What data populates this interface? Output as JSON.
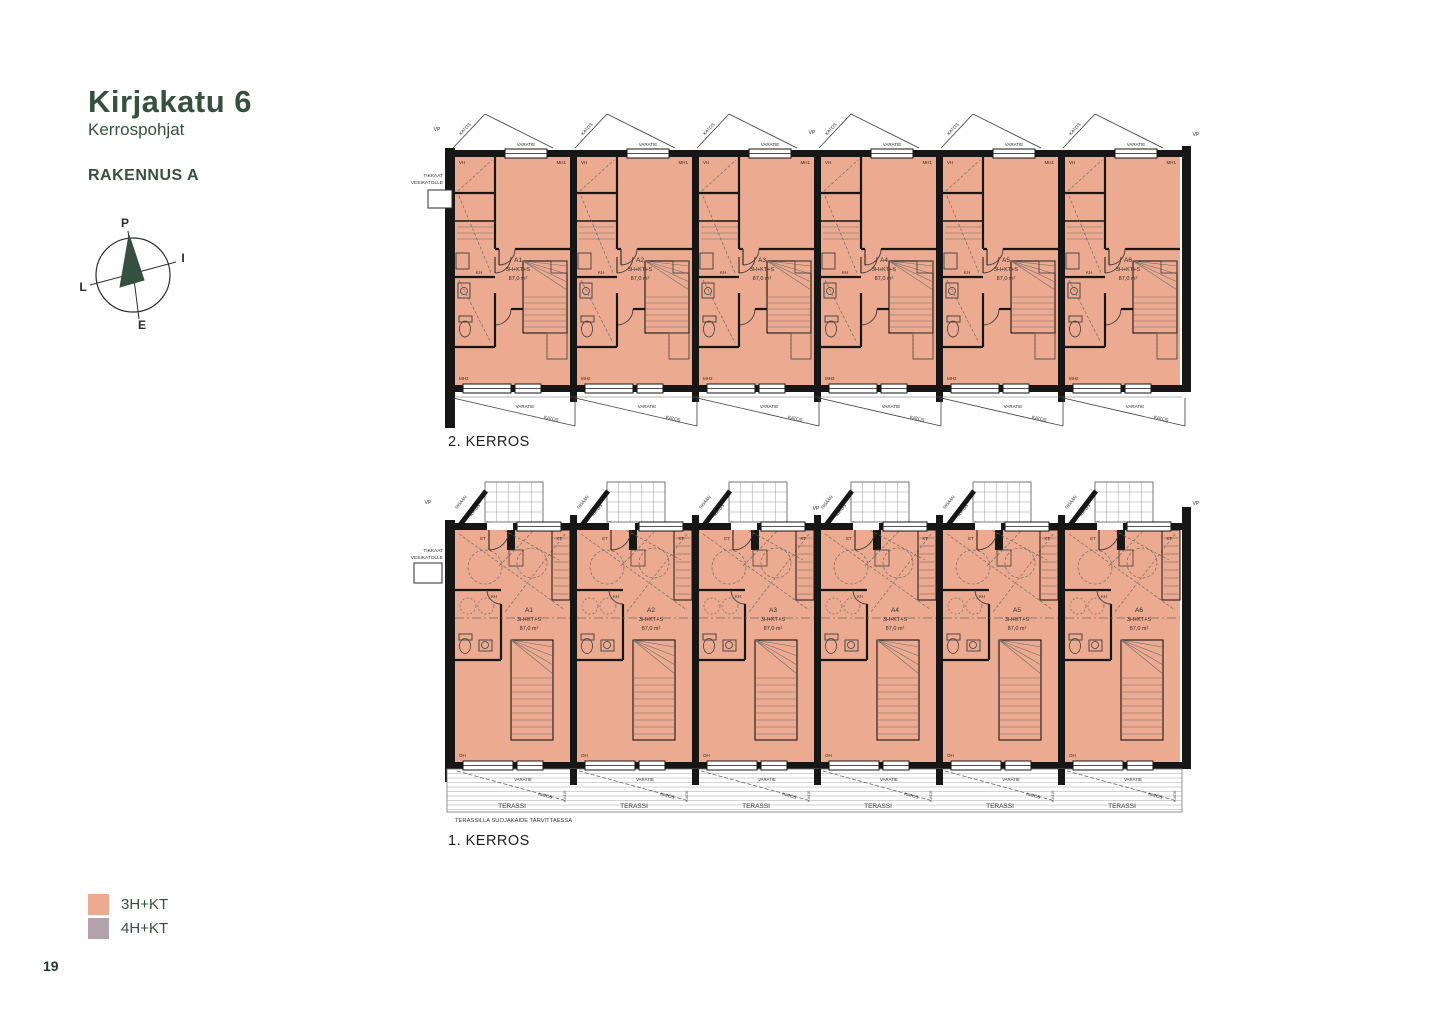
{
  "page": {
    "number": "19"
  },
  "header": {
    "title": "Kirjakatu 6",
    "subtitle": "Kerrospohjat",
    "building": "RAKENNUS A"
  },
  "compass": {
    "north": "P",
    "east": "I",
    "south": "E",
    "west": "L"
  },
  "colors": {
    "plan_fill": "#ecab90",
    "wall": "#161616",
    "thin_line": "#3a3a3a",
    "accent": "#35503f",
    "legend_3hkt": "#eca98d",
    "legend_4hkt": "#b2a2ac"
  },
  "floor2": {
    "caption": "2. KERROS",
    "units": [
      {
        "id": "A1",
        "type": "3H+KT+S",
        "area": "87,0 m²"
      },
      {
        "id": "A2",
        "type": "3H+KT+S",
        "area": "87,0 m²"
      },
      {
        "id": "A3",
        "type": "3H+KT+S",
        "area": "87,0 m²"
      },
      {
        "id": "A4",
        "type": "3H+KT+S",
        "area": "87,0 m²"
      },
      {
        "id": "A5",
        "type": "3H+KT+S",
        "area": "87,0 m²"
      },
      {
        "id": "A6",
        "type": "3H+KT+S",
        "area": "87,0 m²"
      }
    ],
    "labels": {
      "varatie": "VARATIE",
      "katos": "KATOS",
      "vh": "VH",
      "mh1": "MH1",
      "mh2": "MH2",
      "kh": "KH",
      "vp": "VP",
      "ladder_line1": "TIKKAAT",
      "ladder_line2": "VESIKATOLLE"
    }
  },
  "floor1": {
    "caption": "1. KERROS",
    "units": [
      {
        "id": "A1",
        "type": "3H+KT+S",
        "area": "87,0 m²"
      },
      {
        "id": "A2",
        "type": "3H+KT+S",
        "area": "87,0 m²"
      },
      {
        "id": "A3",
        "type": "3H+KT+S",
        "area": "87,0 m²"
      },
      {
        "id": "A4",
        "type": "3H+KT+S",
        "area": "87,0 m²"
      },
      {
        "id": "A5",
        "type": "3H+KT+S",
        "area": "87,0 m²"
      },
      {
        "id": "A6",
        "type": "3H+KT+S",
        "area": "87,0 m²"
      }
    ],
    "labels": {
      "varatie": "VARATIE",
      "katos": "KATOS",
      "sisaan": "SISÄÄN",
      "et": "ET",
      "kt": "KT",
      "kh": "KH",
      "oh": "OH",
      "terassi": "TERASSI",
      "kaide": "KAIDE",
      "vp": "VP",
      "ladder_line1": "TIKKAAT",
      "ladder_line2": "VESIKATOLLE",
      "note": "TERASSILLA SUOJAKAIDE TARVITTAESSA"
    }
  },
  "legend": {
    "items": [
      {
        "label": "3H+KT",
        "color": "#eca98d"
      },
      {
        "label": "4H+KT",
        "color": "#b2a2ac"
      }
    ]
  }
}
